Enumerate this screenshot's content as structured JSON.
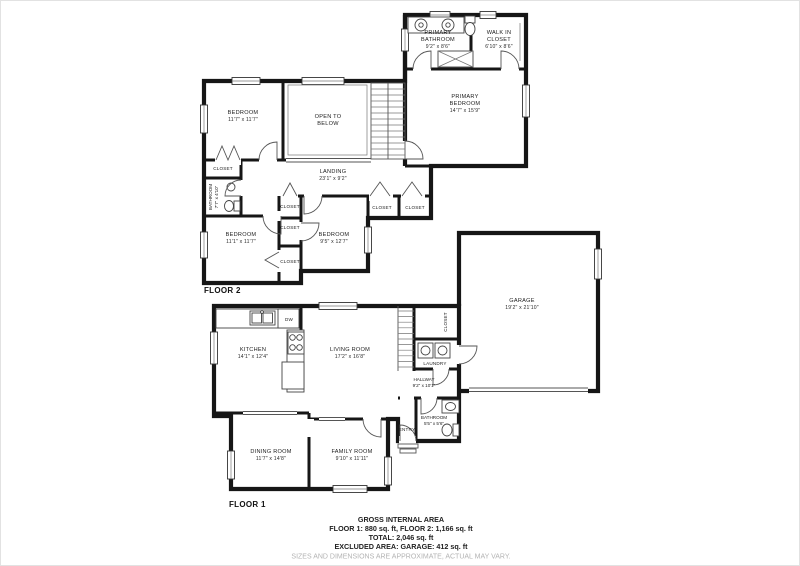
{
  "colors": {
    "wall": "#161616",
    "text": "#1c1c1c",
    "disclaimer": "#b3b3b3"
  },
  "floor2": {
    "label": "FLOOR 2",
    "rooms": {
      "primary_bathroom": {
        "line1": "PRIMARY",
        "line2": "BATHROOM",
        "dims": "9'2\" x 8'6\""
      },
      "walk_in_closet": {
        "line1": "WALK IN",
        "line2": "CLOSET",
        "dims": "6'10\" x 8'6\""
      },
      "primary_bedroom": {
        "line1": "PRIMARY",
        "line2": "BEDROOM",
        "dims": "14'7\" x 15'9\""
      },
      "bedroom_top": {
        "line1": "BEDROOM",
        "dims": "11'7\" x 11'7\""
      },
      "open_to_below": {
        "line1": "OPEN TO",
        "line2": "BELOW"
      },
      "landing": {
        "line1": "LANDING",
        "dims": "23'1\" x 9'2\""
      },
      "bathroom": {
        "line1": "BATHROOM",
        "dims": "7'7\" x 4'10\""
      },
      "bedroom_left": {
        "line1": "BEDROOM",
        "dims": "11'1\" x 11'7\""
      },
      "bedroom_right": {
        "line1": "BEDROOM",
        "dims": "9'5\" x 12'7\""
      },
      "closet": "CLOSET"
    }
  },
  "floor1": {
    "label": "FLOOR 1",
    "rooms": {
      "kitchen": {
        "line1": "KITCHEN",
        "dims": "14'1\" x 12'4\""
      },
      "living_room": {
        "line1": "LIVING ROOM",
        "dims": "17'2\" x 16'8\""
      },
      "dining_room": {
        "line1": "DINING ROOM",
        "dims": "11'7\" x 14'8\""
      },
      "family_room": {
        "line1": "FAMILY ROOM",
        "dims": "9'10\" x 11'11\""
      },
      "garage": {
        "line1": "GARAGE",
        "dims": "19'2\" x 21'10\""
      },
      "hallway": {
        "line1": "HALLWAY",
        "dims": "9'2\" x 10'1\""
      },
      "bathroom": {
        "line1": "BATHROOM",
        "dims": "5'5\" x 5'6\""
      },
      "laundry": "LAUNDRY",
      "entry": "ENTRY",
      "closet": "CLOSET",
      "dw": "DW"
    }
  },
  "footer": {
    "line1": "GROSS INTERNAL AREA",
    "line2": "FLOOR 1: 880 sq. ft, FLOOR 2: 1,166 sq. ft",
    "line3": "TOTAL: 2,046 sq. ft",
    "line4": "EXCLUDED AREA: GARAGE: 412 sq. ft",
    "disclaimer": "SIZES AND DIMENSIONS ARE APPROXIMATE, ACTUAL MAY VARY."
  }
}
